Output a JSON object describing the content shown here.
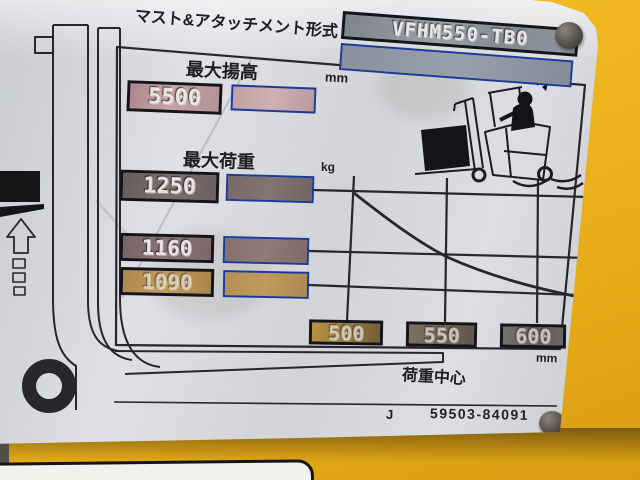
{
  "photo": {
    "scene": "forklift load-capacity name plate riveted to a yellow reach-truck body",
    "colors": {
      "body_yellow": "#eeb41e",
      "plate_gray": "#d6d8db",
      "line_dark": "#26262b",
      "blue_border": "#1d3a96"
    }
  },
  "plate": {
    "header": {
      "label": "マスト&アタッチメント形式",
      "model_value": "VFHM550-TB0",
      "secondary_value": ""
    },
    "lift_height": {
      "label": "最大揚高",
      "unit": "mm",
      "value": "5500",
      "stamped_value": ""
    },
    "capacity": {
      "label": "最大荷重",
      "unit": "kg",
      "rows": [
        {
          "value": "1250"
        },
        {
          "value": "1160"
        },
        {
          "value": "1090"
        }
      ]
    },
    "load_center": {
      "label": "荷重中心",
      "unit": "mm",
      "ticks": [
        "500",
        "550",
        "600"
      ]
    },
    "footer": {
      "prefix": "J",
      "part_number": "59503-84091"
    },
    "icons": {
      "left": "mast-side-view-icon",
      "right": "tipping-reach-truck-icon"
    }
  },
  "chart_data": {
    "type": "line",
    "title": "",
    "x": [
      500,
      550,
      600
    ],
    "series": [
      {
        "name": "最大荷重",
        "values": [
          1250,
          1160,
          1090
        ]
      }
    ],
    "xlabel": "荷重中心 (mm)",
    "ylabel": "最大荷重 (kg)",
    "x_ticks": [
      "500",
      "550",
      "600"
    ],
    "y_gridline_values": [
      1250,
      1160,
      1090
    ],
    "grid": true,
    "legend": false
  }
}
